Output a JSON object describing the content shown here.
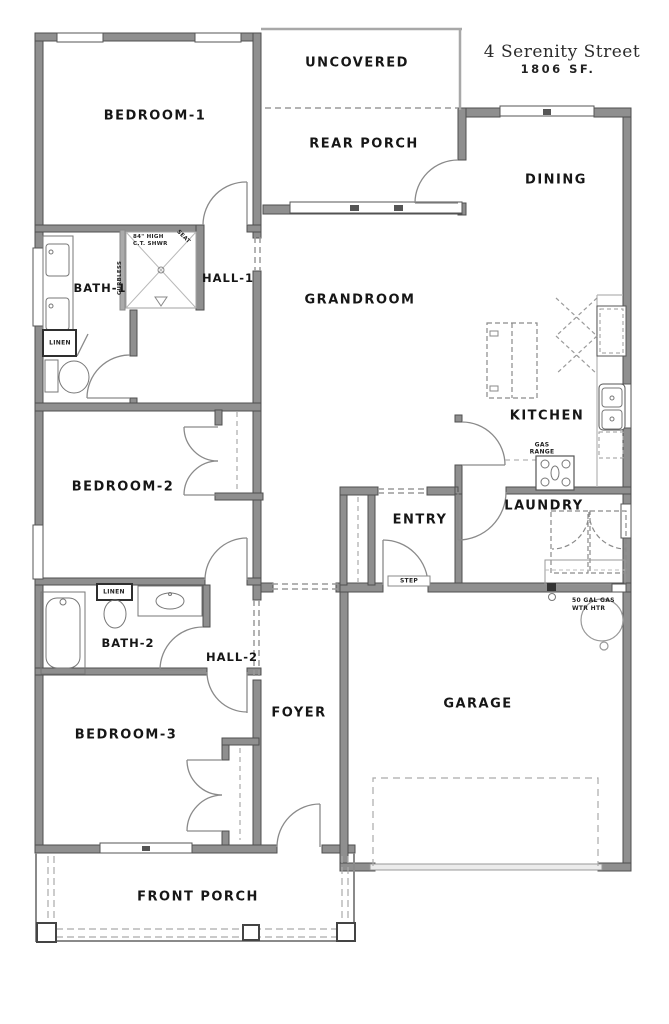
{
  "title": {
    "street": "4 Serenity Street",
    "area": "1806 SF."
  },
  "rooms": [
    {
      "id": "bedroom-1",
      "label": "BEDROOM-1"
    },
    {
      "id": "uncovered",
      "label": "UNCOVERED"
    },
    {
      "id": "rear-porch",
      "label": "REAR PORCH"
    },
    {
      "id": "dining",
      "label": "DINING"
    },
    {
      "id": "grandroom",
      "label": "GRANDROOM"
    },
    {
      "id": "bath-1",
      "label": "BATH-1"
    },
    {
      "id": "hall-1",
      "label": "HALL-1"
    },
    {
      "id": "kitchen",
      "label": "KITCHEN"
    },
    {
      "id": "bedroom-2",
      "label": "BEDROOM-2"
    },
    {
      "id": "entry",
      "label": "ENTRY"
    },
    {
      "id": "laundry",
      "label": "LAUNDRY"
    },
    {
      "id": "bath-2",
      "label": "BATH-2"
    },
    {
      "id": "hall-2",
      "label": "HALL-2"
    },
    {
      "id": "bedroom-3",
      "label": "BEDROOM-3"
    },
    {
      "id": "foyer",
      "label": "FOYER"
    },
    {
      "id": "garage",
      "label": "GARAGE"
    },
    {
      "id": "front-porch",
      "label": "FRONT PORCH"
    }
  ],
  "annotations": {
    "shower_line1": "84\" HIGH",
    "shower_line2": "C.T. SHWR",
    "shower_seat": "SEAT",
    "shower_curbless": "CURBLESS",
    "linen_bath1": "LINEN",
    "linen_bath2": "LINEN",
    "gas_range_line1": "GAS",
    "gas_range_line2": "RANGE",
    "step": "STEP",
    "water_heater_line1": "50 GAL GAS",
    "water_heater_line2": "WTR HTR"
  },
  "colors": {
    "wall": "#8f8f8f",
    "wall_edge": "#4f4f4f",
    "thin_line": "#a8a8a8",
    "text": "#151515",
    "background": "#ffffff"
  }
}
